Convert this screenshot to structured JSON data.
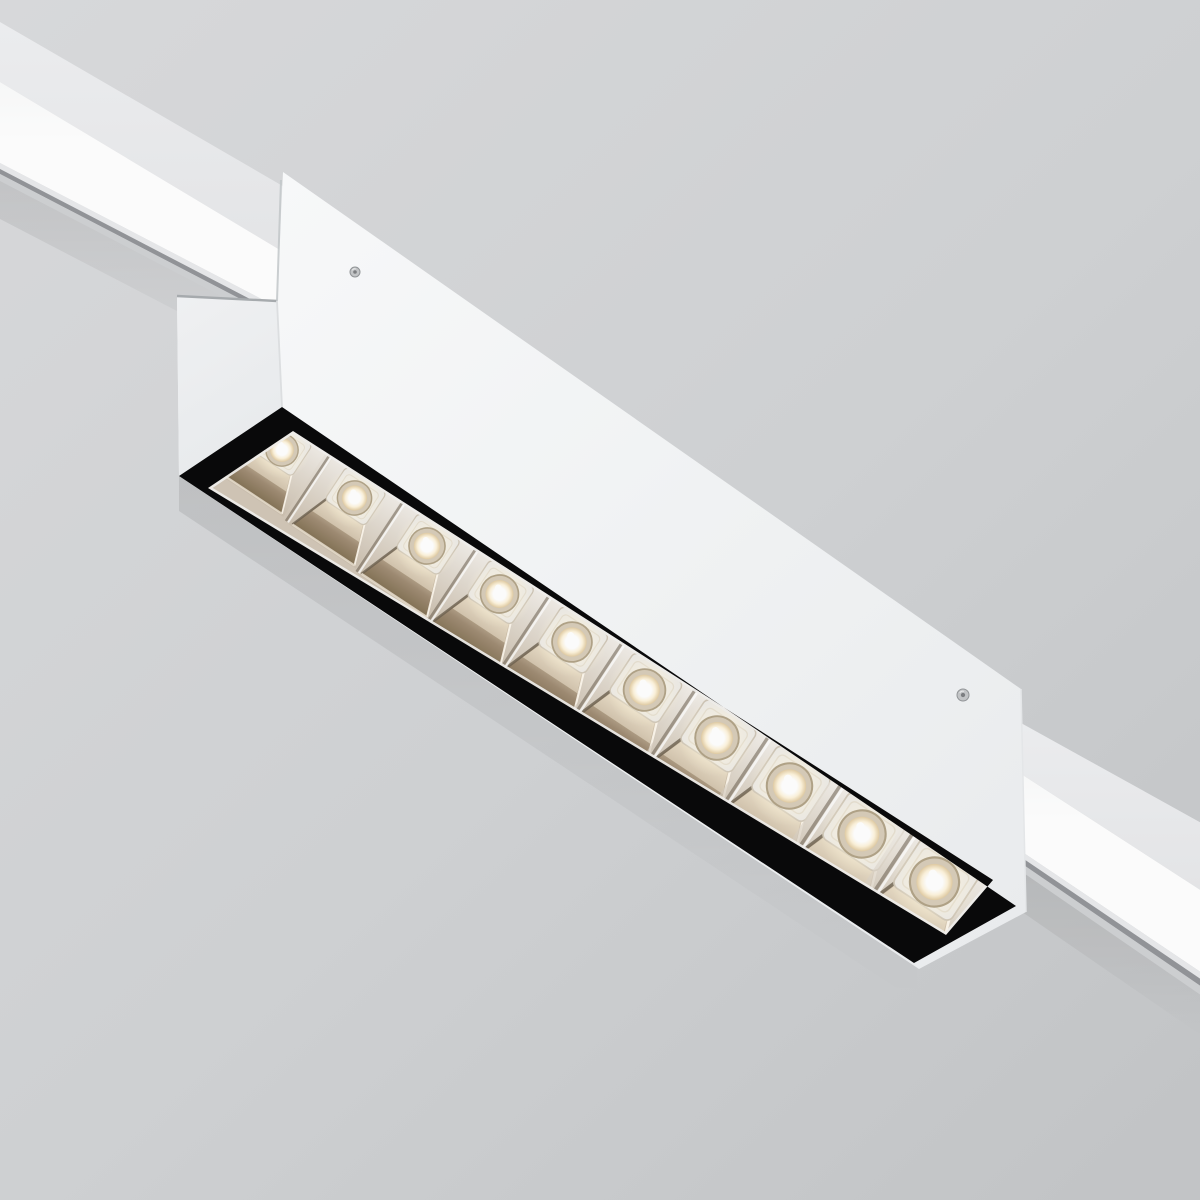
{
  "scene": {
    "description": "White linear magnetic track LED luminaire mounted on a ceiling track running diagonally from upper left to lower right, with ten warm-white LED reflector cells behind a black rectangular bezel",
    "object": "linear-track-led-luminaire",
    "view": "ceiling seen from below",
    "track_angle_deg": 33.5,
    "led_count": 10,
    "screw_count": 2
  },
  "colors": {
    "ceiling_top": "#dbdcde",
    "ceiling_mid": "#d2d4d6",
    "ceiling_bottom": "#c6c8ca",
    "track_face": "#eff0f2",
    "track_strip": "#ffffff",
    "track_lip": "#e9eaec",
    "track_groove": "#94969a",
    "track_under": "#d0d2d4",
    "body_light": "#fbfcfd",
    "body_mid": "#f4f6f7",
    "body_dark": "#edeff1",
    "end_light": "#f2f3f5",
    "end_dark": "#e9ecee",
    "stem_line": "#a9adb0",
    "edge_line": "#c6cacc",
    "frame_black": "#0a0a0b",
    "tray_light": "#f6f4f1",
    "tray_dark": "#d2c7b7",
    "cell_back_light": "#f8f6f3",
    "cell_back_dark": "#c9bdab",
    "wall_light": "#e9ddc7",
    "wall_mid": "#a08d74",
    "wall_dark": "#857357",
    "wall_shadow": "#6e6150",
    "wall_rim": "#fffaf0",
    "plateau": "#edebe7",
    "plateau_edge": "#cfc6b6",
    "ring_fill": "#d8cdb9",
    "ring_edge": "#b2a489",
    "glow_center": "#ffffff",
    "glow_mid": "#fdf3dc",
    "glow_edge": "#e2cda4",
    "halo": "#fff6de",
    "ridge_dark": "#5f5344",
    "ridge_light": "#ffffff",
    "screw_fill": "#c6c8ca",
    "screw_rim": "#94979a",
    "screw_center": "#7e8184"
  },
  "leds": {
    "count": 10,
    "start": [
      282,
      450
    ],
    "step": [
      72.5,
      48.0
    ],
    "angle_deg": 33.5,
    "base_scale": 0.95,
    "scale_step": 0.055,
    "lens_radius": 12.5
  },
  "screws": [
    {
      "x": 355,
      "y": 272,
      "r": 5
    },
    {
      "x": 963,
      "y": 695,
      "r": 6
    }
  ]
}
